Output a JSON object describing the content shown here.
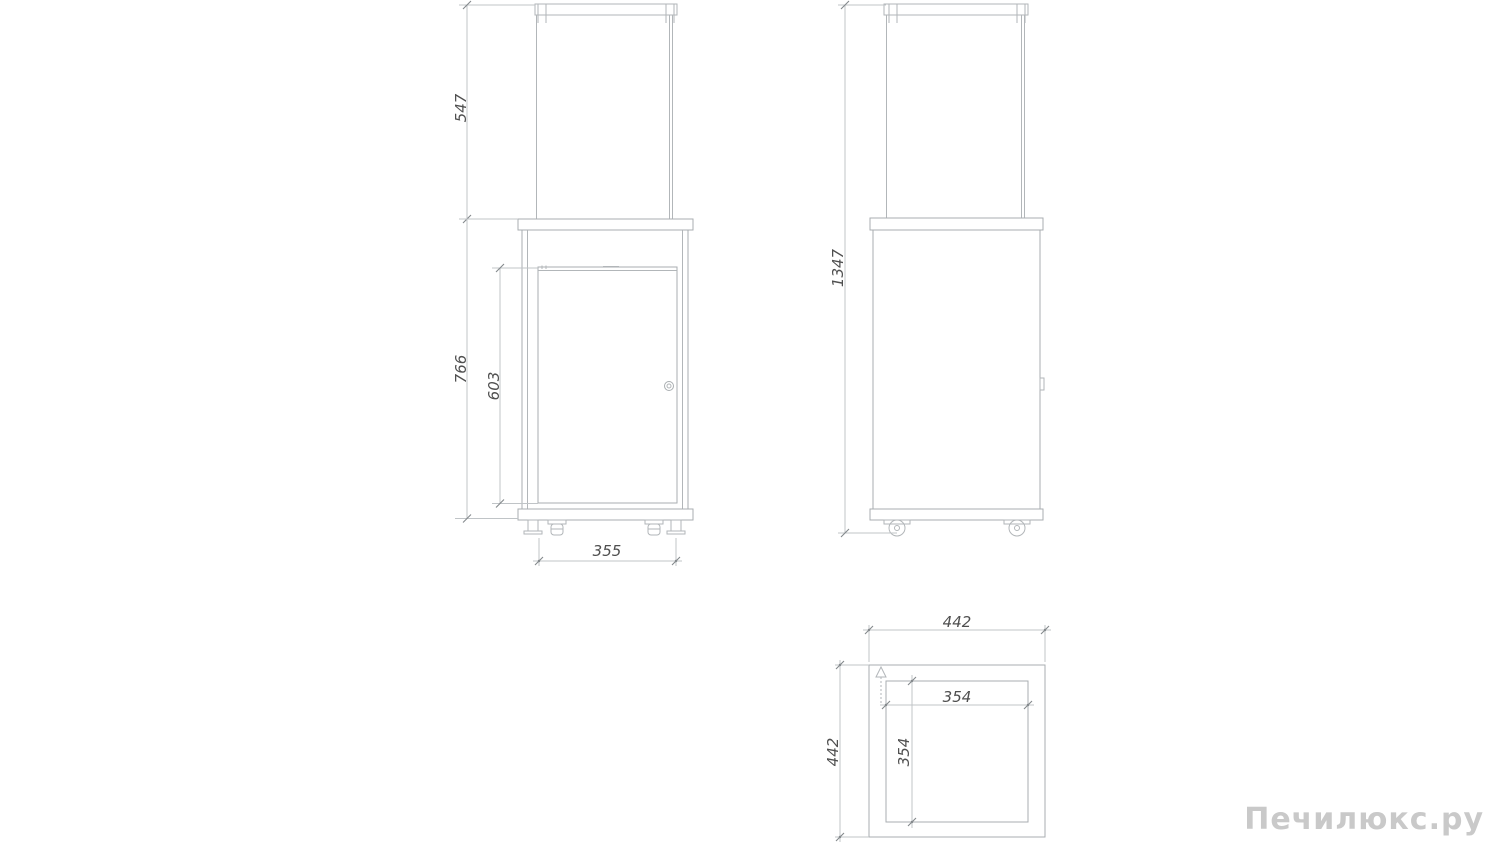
{
  "views": {
    "front": {
      "name": "front-view",
      "dimensions": {
        "glass_height": "547",
        "body_height": "766",
        "door_height": "603",
        "base_width": "355"
      }
    },
    "side": {
      "name": "side-view",
      "dimensions": {
        "total_height": "1347"
      }
    },
    "plan": {
      "name": "plan-view",
      "dimensions": {
        "outer_width": "442",
        "outer_depth": "442",
        "burner_width": "354",
        "burner_depth": "354"
      }
    }
  },
  "watermark": {
    "text": "Печилюкс.ру",
    "color": "#c9c9c9"
  },
  "colors": {
    "object_line": "#b2b6b9",
    "dimension_line": "#c0c4c7",
    "tick": "#84898c",
    "dimension_text": "#4f4f4f",
    "background": "#ffffff"
  }
}
